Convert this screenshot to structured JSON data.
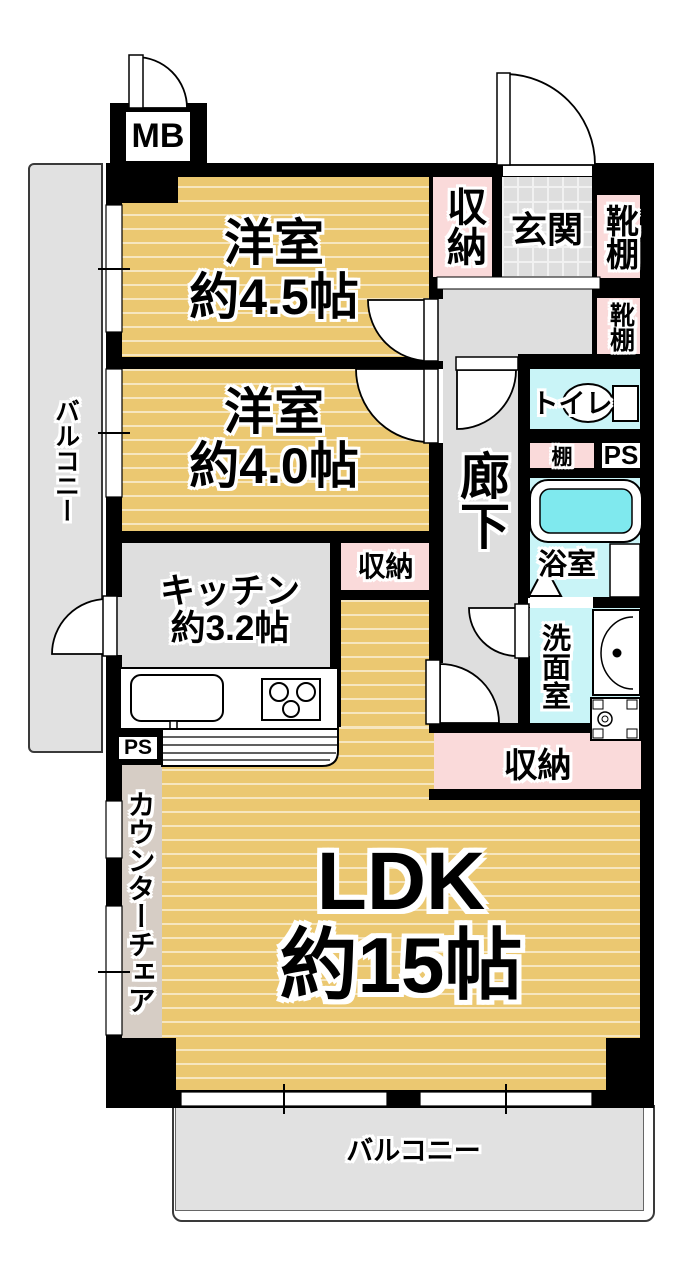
{
  "plan": {
    "title": "マンション間取り図",
    "mb_label": "MB",
    "rooms": {
      "bedroom1": {
        "name": "洋室",
        "size": "約4.5帖"
      },
      "bedroom2": {
        "name": "洋室",
        "size": "約4.0帖"
      },
      "kitchen": {
        "name": "キッチン",
        "size": "約3.2帖"
      },
      "ldk": {
        "name": "LDK",
        "size": "約15帖"
      },
      "genkan": "玄関",
      "hallway": "廊下",
      "toilet": "トイレ",
      "bath": "浴室",
      "washroom": "洗面室"
    },
    "storage": {
      "closet_top": "収納",
      "closet_mid": "収納",
      "closet_bottom": "収納",
      "shoe_shelf_1": "靴棚",
      "shoe_shelf_2": "靴棚",
      "shelf": "棚"
    },
    "pipe_spaces": {
      "ps_right": "PS",
      "ps_left": "PS"
    },
    "balcony": {
      "left": "バルコニー",
      "bottom": "バルコニー"
    },
    "counter_chair": "カウンターチェア",
    "colors": {
      "room-yellow": "#ebc871",
      "closet-pink": "#fadada",
      "wet-cyan": "#c9f4f7",
      "tub-cyan": "#7fe9ee",
      "floor-gray": "#dedede",
      "balcony-gray": "#e1e1e1",
      "counter-beige": "#d6cdc5",
      "wall-black": "#000000"
    }
  }
}
